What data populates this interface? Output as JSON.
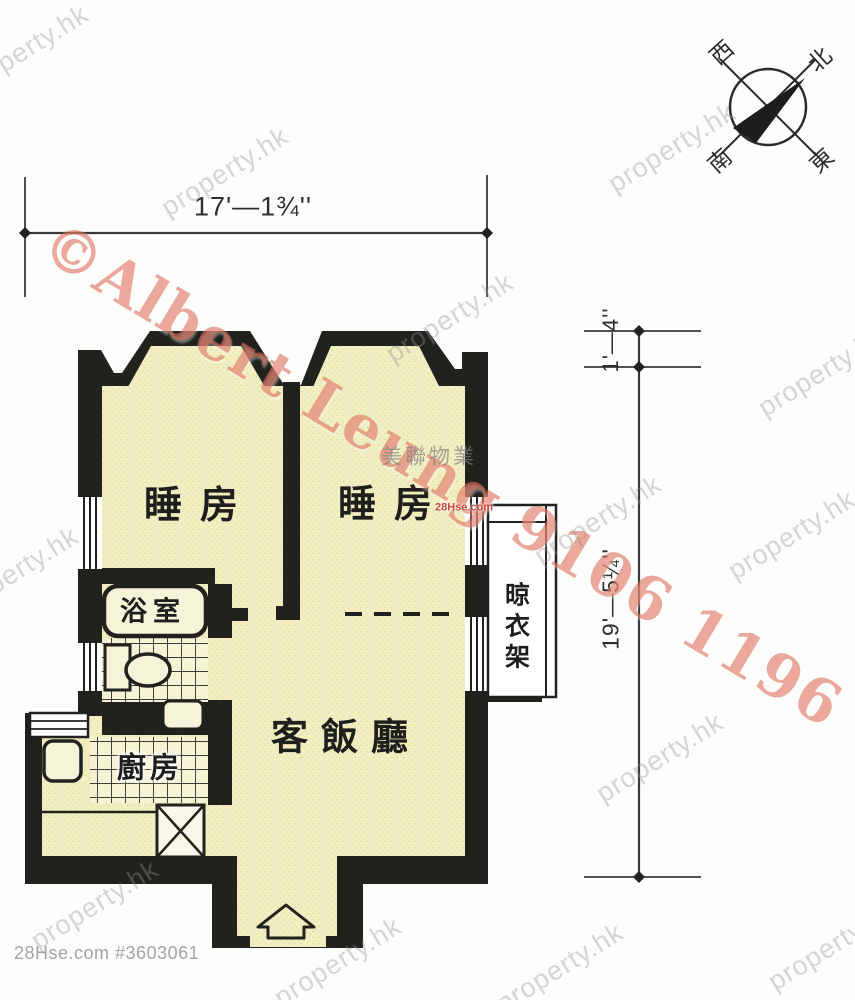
{
  "compass": {
    "west": "西",
    "north": "北",
    "south": "南",
    "east": "東"
  },
  "dimensions": {
    "width_top": "17'—1¾''",
    "right_small": "1'—4''",
    "right_large": "19'—5¼''"
  },
  "rooms": {
    "bedroom_left": "睡房",
    "bedroom_right": "睡房",
    "bathroom": "浴室",
    "kitchen": "廚房",
    "living_dining": "客飯廳",
    "drying_rack": "晾衣架"
  },
  "watermarks": {
    "agent": "©Albert Leung 9106 1196",
    "site": "property.hk",
    "agency": "美聯物業",
    "stamp": "28Hse.com"
  },
  "meta": {
    "footer": "28Hse.com #3603061"
  },
  "colors": {
    "wall": "#21211d",
    "floor": "#f1eec1",
    "fixture": "#f6f4d8",
    "watermark_red": "#de6e5a",
    "watermark_gray": "#949494"
  }
}
